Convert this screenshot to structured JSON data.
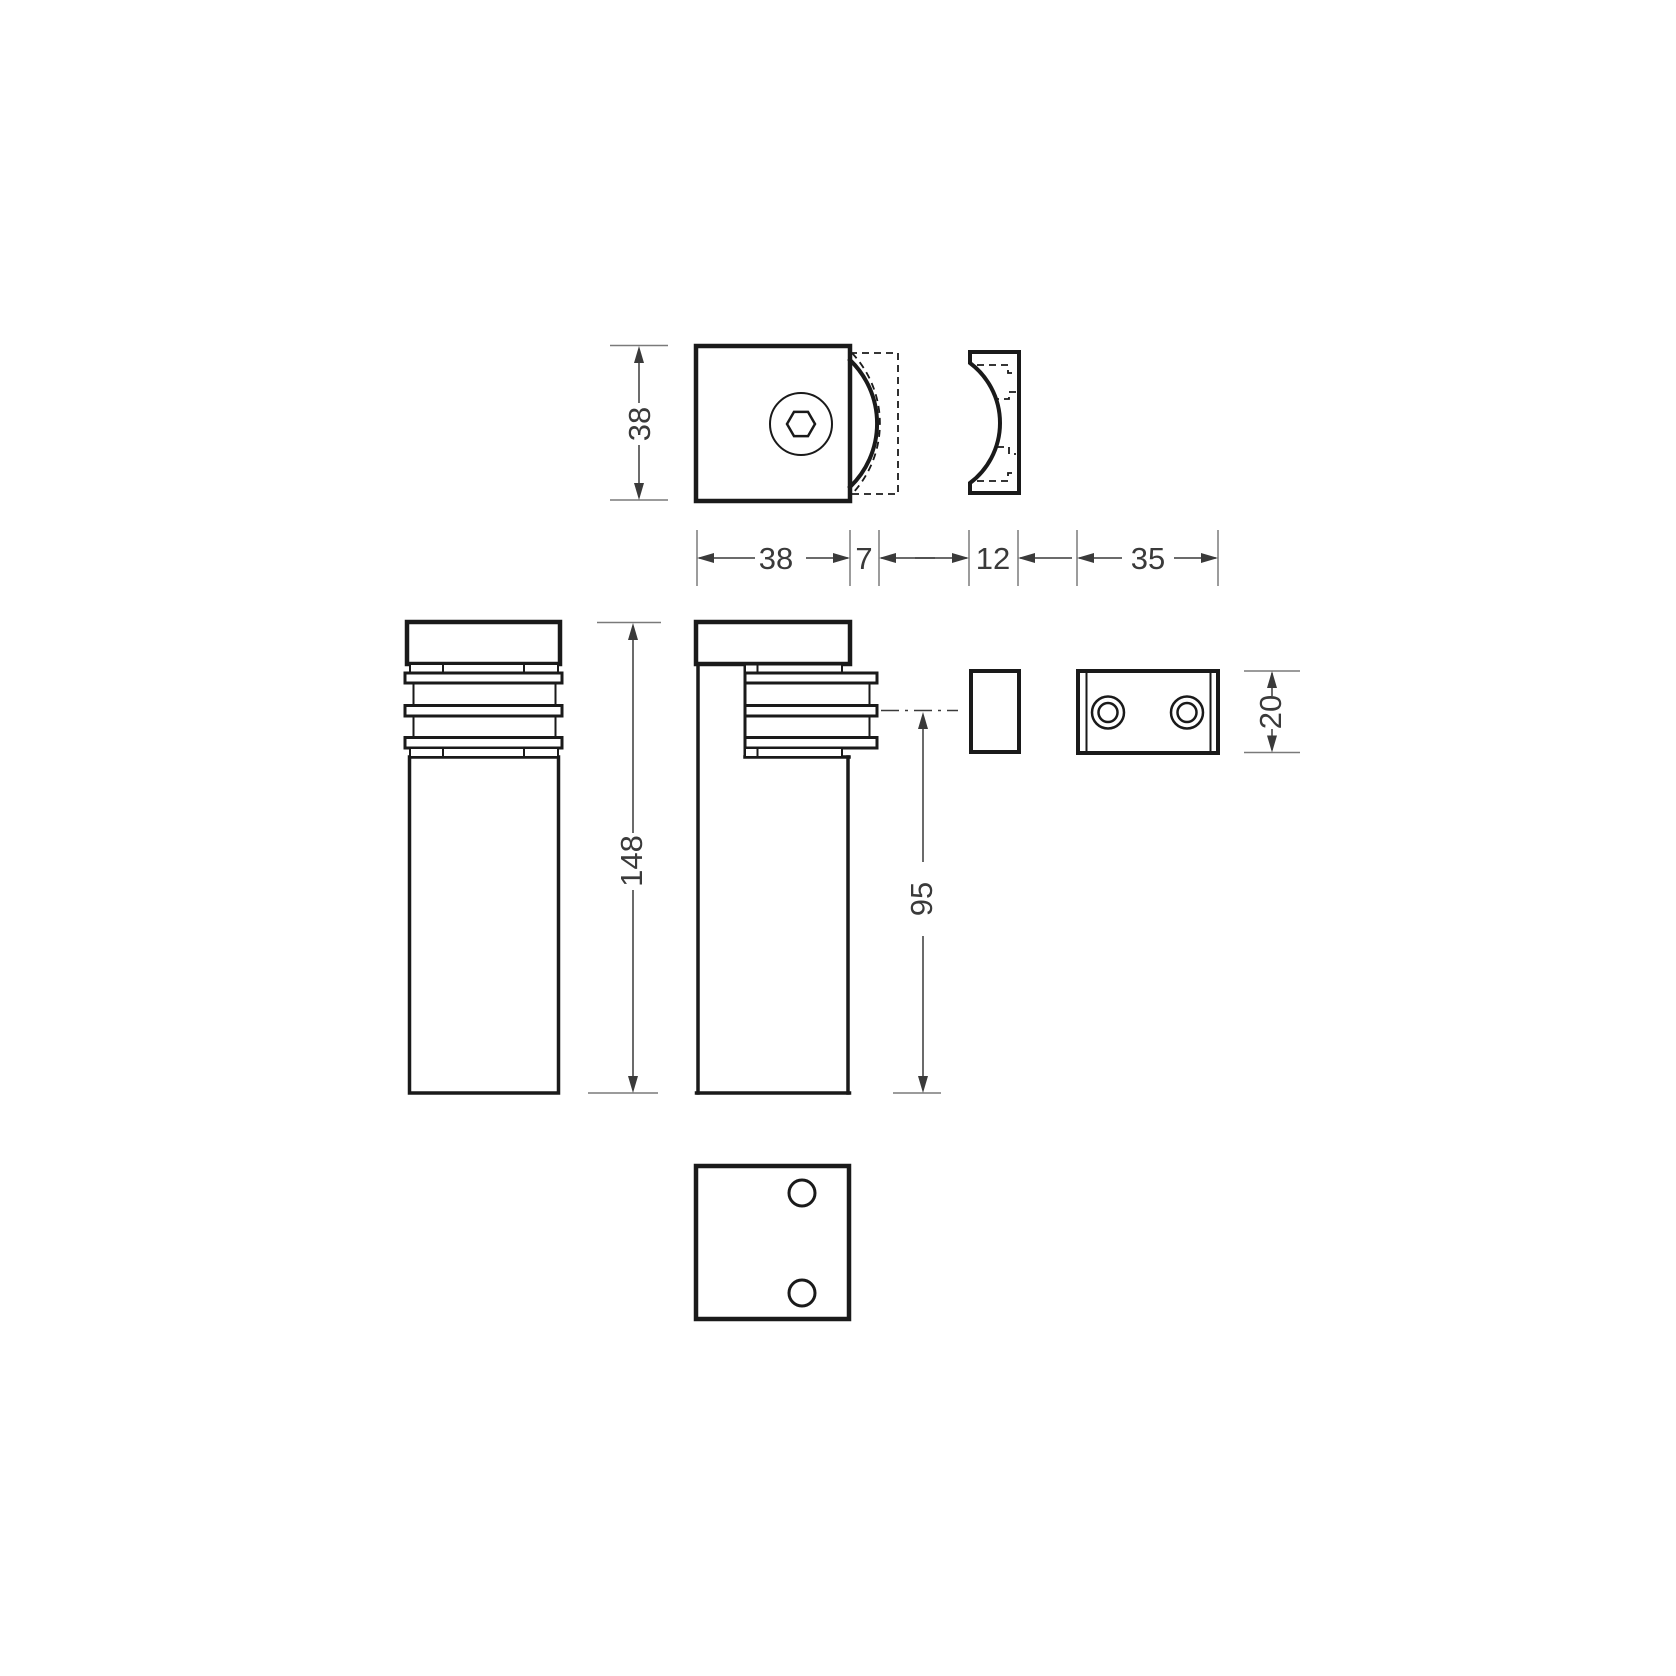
{
  "dims": {
    "clamp_height": "38",
    "clamp_width": "38",
    "clamp_projection": "7",
    "gasket_thickness": "12",
    "backplate_width": "35",
    "body_height": "148",
    "clamp_center_height": "95",
    "backplate_height": "20"
  },
  "colors": {
    "line": "#1a1a1a",
    "dimline": "#7a7a7a",
    "dimtext": "#3a3a3a",
    "background": "#ffffff"
  }
}
